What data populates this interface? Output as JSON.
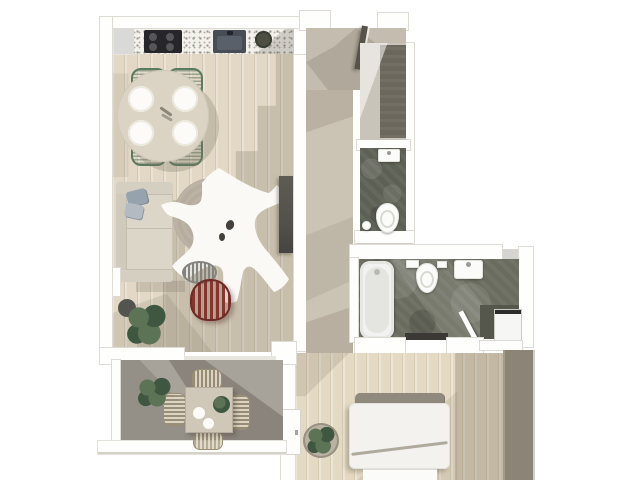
{
  "scene": {
    "kind": "3d-rendered-floor-plan-top-view",
    "description": "Top-down 3D architectural rendering of a one-bedroom apartment with open living/dining/kitchen, entrance hall, storage closet, guest WC, bathroom with laundry niche, bedroom and a terrace",
    "background": "#ffffff",
    "no_visible_text": true
  },
  "palette": {
    "bg": "#ffffff",
    "wall": "#fefefd",
    "wallLine": "#dedbd4",
    "woodLight": "#e2d8c5",
    "bedroomWood": "#e4d9c2",
    "hallFloor": "#cbc3b3",
    "entryFloor": "#c4bcae",
    "closetFloor": "#c9c4b9",
    "closetDark": "#6b675c",
    "wcFloor": "#5d6054",
    "bathFloor": "#6a6c5f",
    "nicheFloor": "#55564c",
    "balconyFloor": "#a8a39a",
    "counterTerrazzo": "#f3f1ec",
    "speckle": "#97968e",
    "cooktop": "#26262a",
    "burner": "#55555a",
    "sinkDark": "#474c55",
    "sinkInner": "#596069",
    "bowlOlive": "#4c4f41",
    "tableCream": "#dbd3c4",
    "plate": "#fcfbf8",
    "chairGreen": "#5c7a60",
    "sofa": "#dcd6c9",
    "sofaLine": "#c4beb0",
    "pillowBlueA": "#97a2af",
    "pillowBlueB": "#b3bac2",
    "rugCircle": "#b6ad9e",
    "cowhide": "#fcfbf8",
    "cowSpot": "#45403a",
    "tvDark": "#53514b",
    "stoolRed": "#84352e",
    "stoolRedEdge": "#6e2b26",
    "stoolGray": "#84847f",
    "plantDark": "#3f5741",
    "plantMid": "#5c7355",
    "potGray": "#54544e",
    "glass": "#c6cbd1",
    "doorDark": "#57524a",
    "fixtureWhite": "#fbfbf9",
    "tubInner": "#e4e5e1",
    "threshold": "#3b3935",
    "washerWhite": "#f6f6f4",
    "washerTop": "#2e2d2b",
    "wardrobe": "#8c8577",
    "bedPillow": "#8f897e",
    "bedDuvet": "#f3f2ef",
    "bedFold": "#b0aa9e",
    "wickerEdge": "#9a8f74",
    "shadowTint": "99,90,76"
  },
  "rooms": [
    {
      "id": "living-dining",
      "contents": [
        "sofa",
        "throw-pillows",
        "round-rug",
        "cowhide-rug",
        "tv-sideboard",
        "wire-stool-red",
        "wire-stool-gray",
        "potted-plant"
      ]
    },
    {
      "id": "kitchen",
      "contents": [
        "counter",
        "cooktop-4-burners",
        "sink",
        "counter-bowl",
        "fridge-block"
      ]
    },
    {
      "id": "dining-area",
      "contents": [
        "round-table",
        "4-plates",
        "4-green-chairs"
      ]
    },
    {
      "id": "entrance-hall",
      "contents": [
        "entry-door",
        "sidelight-glass"
      ]
    },
    {
      "id": "corridor",
      "contents": []
    },
    {
      "id": "storage-closet",
      "contents": [
        "dark-wardrobe-unit",
        "door-swing"
      ]
    },
    {
      "id": "guest-wc",
      "contents": [
        "small-sink",
        "toilet",
        "waste-bin"
      ]
    },
    {
      "id": "bathroom",
      "contents": [
        "bathtub",
        "toilet",
        "sink",
        "threshold-mat"
      ]
    },
    {
      "id": "laundry-niche",
      "contents": [
        "washing-machine",
        "door-leaf"
      ]
    },
    {
      "id": "bedroom",
      "contents": [
        "double-bed",
        "pillows",
        "duvet",
        "wardrobe",
        "potted-plant",
        "balcony-door"
      ]
    },
    {
      "id": "terrace",
      "contents": [
        "outdoor-table",
        "4-wicker-chairs",
        "table-plant",
        "potted-plant",
        "railing"
      ]
    }
  ]
}
